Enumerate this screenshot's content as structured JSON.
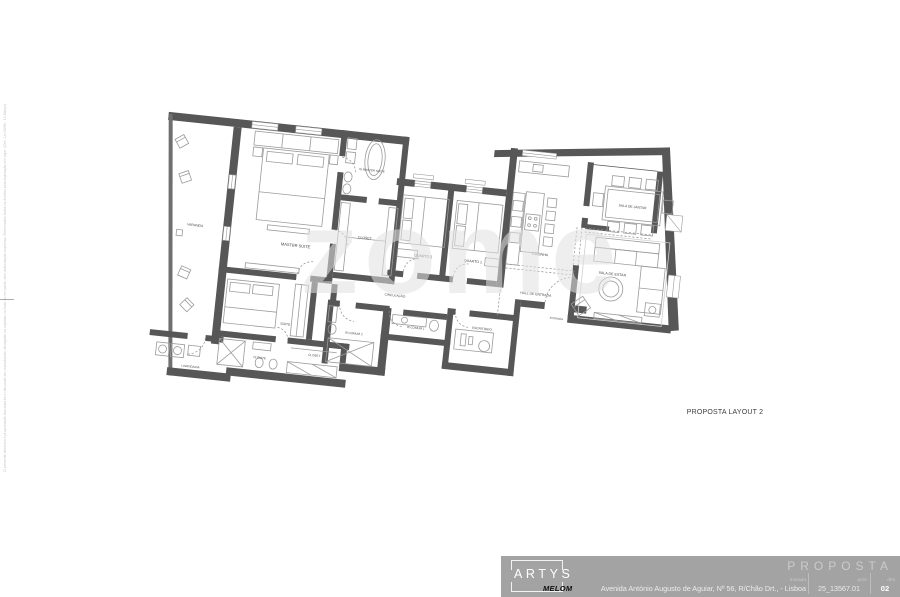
{
  "plan": {
    "drawing_title": "PROPOSTA LAYOUT 2",
    "watermark": "zome",
    "rooms": [
      {
        "id": "varanda",
        "label": "VARANDA"
      },
      {
        "id": "master-suite",
        "label": "MASTER SUITE"
      },
      {
        "id": "is-master-suite",
        "label": "IS MASTER SUITE"
      },
      {
        "id": "closet-master",
        "label": "CLOSET"
      },
      {
        "id": "quarto-2",
        "label": "QUARTO 2"
      },
      {
        "id": "quarto-1",
        "label": "QUARTO 1"
      },
      {
        "id": "circulacao",
        "label": "CIRCULAÇÃO"
      },
      {
        "id": "cozinha",
        "label": "COZINHA"
      },
      {
        "id": "sala-de-jantar",
        "label": "SALA DE JANTAR"
      },
      {
        "id": "sala-de-estar",
        "label": "SALA DE ESTAR"
      },
      {
        "id": "hall-de-entrada",
        "label": "HALL DE ENTRADA"
      },
      {
        "id": "entrada",
        "label": "ENTRADA"
      },
      {
        "id": "escritorio",
        "label": "ESCRITÓRIO"
      },
      {
        "id": "is-comum-1",
        "label": "IS COMUM 1"
      },
      {
        "id": "is-comum-2",
        "label": "IS COMUM 2"
      },
      {
        "id": "suite",
        "label": "SUITE"
      },
      {
        "id": "is-suite",
        "label": "IS SUITE"
      },
      {
        "id": "closet-suite",
        "label": "CLOSET"
      },
      {
        "id": "lavandaria",
        "label": "LAVANDARIA"
      }
    ]
  },
  "title_block": {
    "doc_type": "PROPOSTA",
    "brand": "ARTYS",
    "brand_sub": "MELOM",
    "fields": [
      {
        "label": "morada",
        "value": "Avenida António Augusto de Aguiar, Nº 56, R/Chão Drt., - Lisboa"
      },
      {
        "label": "proc",
        "value": "25_13567.01"
      },
      {
        "label": "des",
        "value": "02"
      }
    ]
  },
  "side_note": "O presente desenho é propriedade dos autores e não pode ser reproduzido, divulgado ou copiado, no todo ou em parte, sem autorização expressa. Reservados todos os direitos pela legislação em vigor. (Dec. Lei 63/85 - 14 Março)",
  "palette": {
    "wall": "#575757",
    "furniture_line": "#9b9b9b",
    "label_text": "#474747",
    "title_block_bg": "#a3a3a3"
  }
}
